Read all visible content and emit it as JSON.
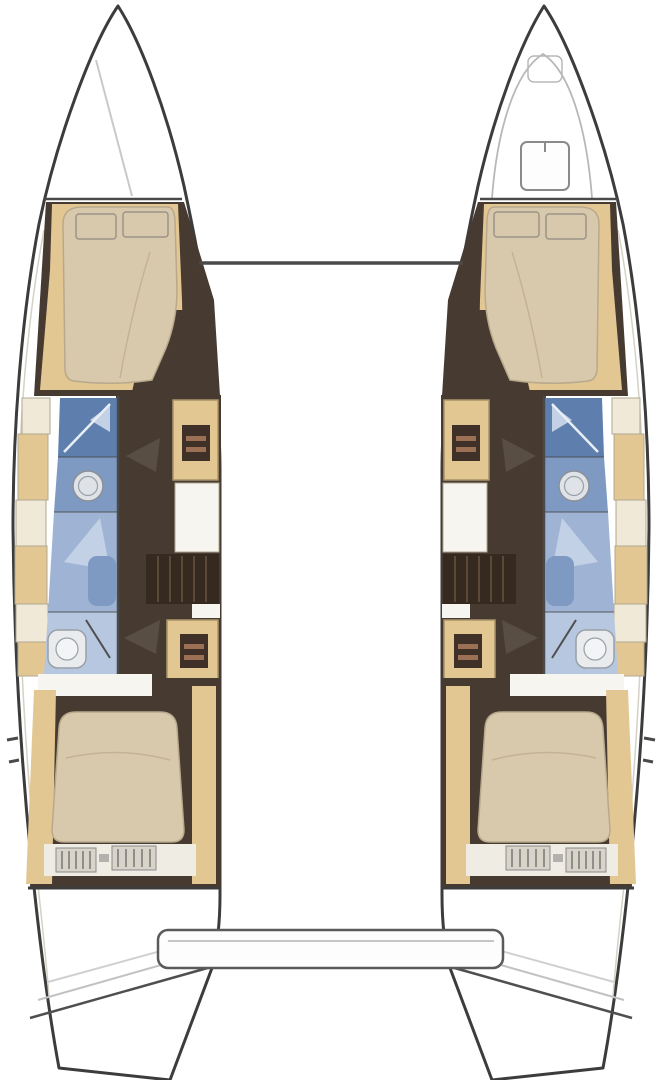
{
  "meta": {
    "title": "Catamaran interior layout floor plan",
    "diagram_type": "boat-floor-plan",
    "view": "top-down",
    "text_on_image": ""
  },
  "colors": {
    "background": "#ffffff",
    "hull_outline": "#3c3c3c",
    "hull_fill": "#ffffff",
    "inner_skin": "#d6d1c6",
    "faint_line": "#c9c9c9",
    "bow_line": "#b8b8b8",
    "beam_line": "#4a4a4a",
    "floor_dark": "#473a31",
    "steps_dark": "#362a20",
    "steps_slat": "#5c4a38",
    "hatch_dark": "#3f3028",
    "hatch_stripe": "#9c7054",
    "wood_tan": "#e3c793",
    "wood_tan_border": "#a8946a",
    "wood_light": "#f1e9d8",
    "locker_border": "#b0a890",
    "cushion": "#d8c9ad",
    "cushion_border": "#b8a98c",
    "cushion_crease": "#c3b394",
    "pillow_border": "#9a9488",
    "bath_blue_dark": "#5e7fae",
    "bath_blue_mid": "#7f9ac2",
    "bath_blue_light": "#9fb4d4",
    "bath_blue_pale": "#b7c7e0",
    "bath_wedge": "#c3d1e6",
    "shower_glass": "#e8eef6",
    "fixture_fill": "#e9ebed",
    "fixture_fill2": "#f3f4f6",
    "fixture_line": "#98a0a8",
    "sink_fill": "#dfe2e6",
    "sink_line": "#8b9097",
    "counter_white": "#f7f5f0",
    "band_white": "#efece4",
    "grille_fill": "#d9d4c9",
    "grille_line": "#767676",
    "grille_border": "#8a8a8a",
    "arrow_dark": "#5d5248",
    "step_line_dark": "#4f4f4f",
    "step_line_light": "#c2c2c2",
    "step_line_lighter": "#d0d0d0",
    "platform_fill": "#fdfdfd",
    "platform_line": "#5a5a5a",
    "platform_inner": "#c6c6c6"
  },
  "structure": {
    "hulls": [
      {
        "side": "port",
        "rooms": [
          {
            "name": "bow-locker",
            "features": [
              "locker-line"
            ]
          },
          {
            "name": "forward-cabin",
            "features": [
              "double-berth",
              "pillow",
              "pillow",
              "side-shelf",
              "side-shelf"
            ]
          },
          {
            "name": "forward-head",
            "features": [
              "shower",
              "washbasin",
              "vanity"
            ]
          },
          {
            "name": "companionway",
            "features": [
              "stair-hatch",
              "worktop",
              "steps",
              "stair-hatch",
              "door-arrow",
              "door-arrow"
            ]
          },
          {
            "name": "aft-head",
            "features": [
              "shower",
              "toilet"
            ]
          },
          {
            "name": "aft-cabin",
            "features": [
              "double-berth",
              "storage-grille",
              "storage-grille"
            ]
          },
          {
            "name": "transom",
            "features": [
              "swim-steps"
            ]
          }
        ]
      },
      {
        "side": "starboard",
        "rooms": [
          {
            "name": "bow-locker",
            "features": [
              "anchor-locker",
              "deck-hatch"
            ]
          },
          {
            "name": "forward-cabin",
            "features": [
              "double-berth",
              "pillow",
              "pillow",
              "side-shelf",
              "side-shelf"
            ]
          },
          {
            "name": "forward-head",
            "features": [
              "shower",
              "washbasin",
              "vanity"
            ]
          },
          {
            "name": "companionway",
            "features": [
              "stair-hatch",
              "worktop",
              "steps",
              "stair-hatch",
              "door-arrow",
              "door-arrow"
            ]
          },
          {
            "name": "aft-head",
            "features": [
              "shower",
              "toilet"
            ]
          },
          {
            "name": "aft-cabin",
            "features": [
              "double-berth",
              "storage-grille",
              "storage-grille"
            ]
          },
          {
            "name": "transom",
            "features": [
              "swim-steps"
            ]
          }
        ]
      }
    ],
    "deck": {
      "features": [
        "forward-crossbeam",
        "aft-platform",
        "transom-gap"
      ]
    }
  }
}
